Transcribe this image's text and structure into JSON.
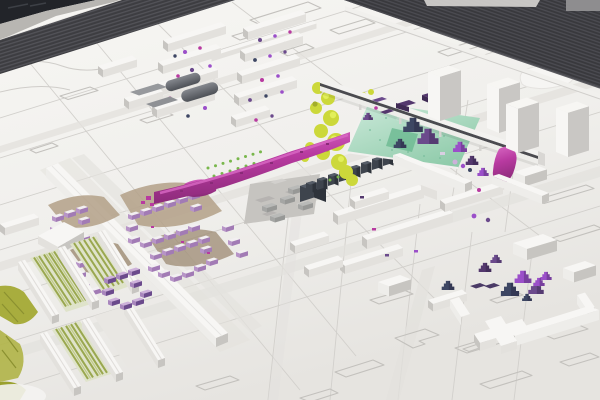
{
  "image": {
    "kind": "photograph",
    "subject": "architectural urban-design scale model seen from an oblique aerial angle; white volumetric buildings on an engraved white baseboard, dark railway yard along the top, bright magenta, purple, lime-green and mint accents marking special structures, trees and open spaces"
  },
  "colors": {
    "base": "#f0efec",
    "base_hi": "#f7f6f3",
    "base_lo": "#e6e4e0",
    "etch_line": "#cfcdc9",
    "road_band": "#e3e1dd",
    "corner_dark": "#222429",
    "edge_band": "#b8b6b2",
    "track_dark": "#3d3d41",
    "track_dark2": "#39393d",
    "track_stripe": "#55555b",
    "track_stripe2": "#4d4d53",
    "building_top": "#f7f6f4",
    "building_front": "#e3e1dd",
    "building_side": "#c7c5c1",
    "wall_white": "#eeedea",
    "tower_side": "#c9c7c4",
    "gray_roof": "#97999d",
    "hall_hi": "#85888e",
    "hall_lo": "#4e5157",
    "charcoal": "#3e444d",
    "charcoal_side": "#2e333b",
    "charcoal_top": "#565d68",
    "concrete": "#c6c4c0",
    "concrete_dark": "#b1afac",
    "magenta": "#b83aa0",
    "magenta_hi": "#d969c4",
    "magenta_lo": "#8a2a78",
    "plaza_green": "#8fcbaa",
    "plaza_hi": "#cdeadb",
    "plaza_lo": "#6cb991",
    "lime": "#ccd83a",
    "lime_hi": "#e2ef5a",
    "lime_lo": "#a3ad2b",
    "olive": "#a8ad3e",
    "court_bg": "#dfe3ca",
    "court_stripe": "#9aa84f",
    "court_stripe_hi": "#c0ca8a",
    "hedge": "#79b74c",
    "tree_purple": "#6b4a8c",
    "tree_violet": "#9b4fc9",
    "tree_navy": "#3d4663",
    "tree_darkpurple": "#54386e",
    "lavender": "#cdb1da",
    "lavender_wall": "#a886bd",
    "courtyard_top": "#f2eff1",
    "courtyard_wall": "#b794c7",
    "courtyard_wall_shade": "#a27bb5",
    "tan_ground": "#b3a087",
    "tan_dark": "#9c8a72"
  },
  "scene": {
    "elements": [
      {
        "name": "railway-yard",
        "color_key": "track_dark"
      },
      {
        "name": "rail-viaduct",
        "color_key": "building_top"
      },
      {
        "name": "high-rise-towers",
        "count": 4,
        "color_key": "building_top"
      },
      {
        "name": "magenta-linear-structure",
        "color_key": "magenta"
      },
      {
        "name": "green-plaza",
        "color_key": "plaza_green"
      },
      {
        "name": "stepped-pyramid-trees",
        "count": 16,
        "color_keys": [
          "tree_purple",
          "tree_violet",
          "tree_navy",
          "tree_darkpurple"
        ]
      },
      {
        "name": "lime-green-foliage",
        "color_key": "lime"
      },
      {
        "name": "charcoal-buildings",
        "count": 9,
        "color_key": "charcoal"
      },
      {
        "name": "industrial-halls-gray-roofs",
        "count": 2,
        "color_key": "hall_hi"
      },
      {
        "name": "courtyard-block-clusters",
        "color_key": "courtyard_wall"
      },
      {
        "name": "lavender-block-cluster",
        "color_key": "lavender"
      },
      {
        "name": "long-diagonal-slab-building",
        "color_key": "building_top"
      },
      {
        "name": "slab-housing-rows",
        "color_key": "building_top"
      },
      {
        "name": "green-striped-courtyards",
        "color_key": "court_stripe"
      },
      {
        "name": "olive-meadow-patches",
        "color_key": "olive"
      },
      {
        "name": "etched-street-grid",
        "color_key": "etch_line"
      },
      {
        "name": "vacant-parcel-outlines",
        "color_key": "etch_line"
      }
    ]
  }
}
